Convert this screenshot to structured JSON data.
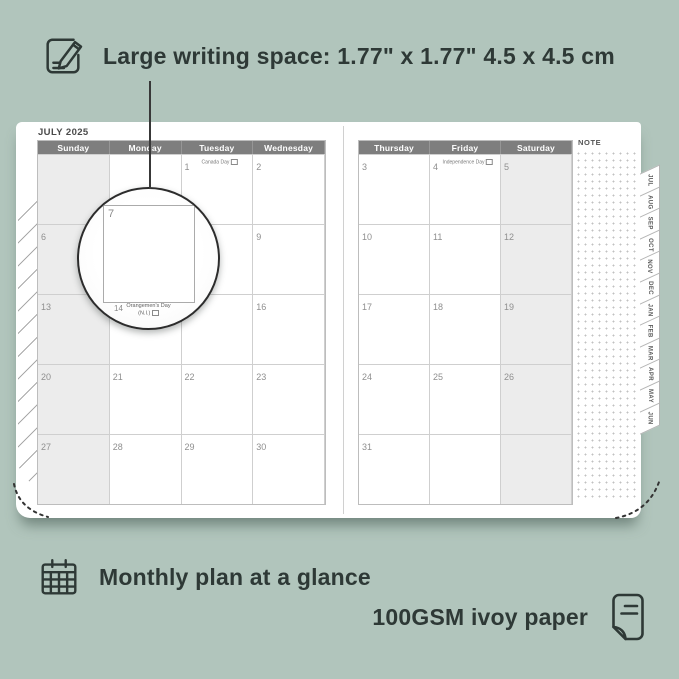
{
  "colors": {
    "background": "#b1c5bc",
    "ink": "#2e3936",
    "paper": "#ffffff",
    "header_bar": "#7e7e7e",
    "shaded_cell": "#ececec"
  },
  "annotations": {
    "top_feature": "Large writing space: 1.77\" x 1.77\"  4.5 x 4.5 cm",
    "monthly_feature": "Monthly plan at a glance",
    "paper_feature": "100GSM ivoy paper"
  },
  "icons": {
    "top": "pencil-note-icon",
    "monthly": "calendar-grid-icon",
    "paper": "paper-sheet-icon"
  },
  "planner": {
    "month_title": "JULY 2025",
    "note_label": "NOTE",
    "left_page": {
      "day_headers": [
        "Sunday",
        "Monday",
        "Tuesday",
        "Wednesday"
      ],
      "rows": [
        [
          {
            "d": ""
          },
          {
            "d": ""
          },
          {
            "d": "1",
            "h": "Canada Day"
          },
          {
            "d": "2"
          }
        ],
        [
          {
            "d": "6"
          },
          {
            "d": "7"
          },
          {
            "d": "8"
          },
          {
            "d": "9"
          }
        ],
        [
          {
            "d": "13"
          },
          {
            "d": "14",
            "h": "Orangemen's Day (N.I.)"
          },
          {
            "d": "15"
          },
          {
            "d": "16"
          }
        ],
        [
          {
            "d": "20"
          },
          {
            "d": "21"
          },
          {
            "d": "22"
          },
          {
            "d": "23"
          }
        ],
        [
          {
            "d": "27"
          },
          {
            "d": "28"
          },
          {
            "d": "29"
          },
          {
            "d": "30"
          }
        ]
      ]
    },
    "right_page": {
      "day_headers": [
        "Thursday",
        "Friday",
        "Saturday"
      ],
      "rows": [
        [
          {
            "d": "3"
          },
          {
            "d": "4",
            "h": "Independence Day"
          },
          {
            "d": "5"
          }
        ],
        [
          {
            "d": "10"
          },
          {
            "d": "11"
          },
          {
            "d": "12"
          }
        ],
        [
          {
            "d": "17"
          },
          {
            "d": "18"
          },
          {
            "d": "19"
          }
        ],
        [
          {
            "d": "24"
          },
          {
            "d": "25"
          },
          {
            "d": "26"
          }
        ],
        [
          {
            "d": "31"
          },
          {
            "d": ""
          },
          {
            "d": ""
          }
        ]
      ]
    },
    "month_tabs": [
      "JUL",
      "AUG",
      "SEP",
      "OCT",
      "NOV",
      "DEC",
      "JAN",
      "FEB",
      "MAR",
      "APR",
      "MAY",
      "JUN"
    ],
    "magnifier": {
      "date": "7",
      "next_date": "14",
      "next_holiday_line1": "Orangemen's Day",
      "next_holiday_line2": "(N.I.)"
    }
  }
}
